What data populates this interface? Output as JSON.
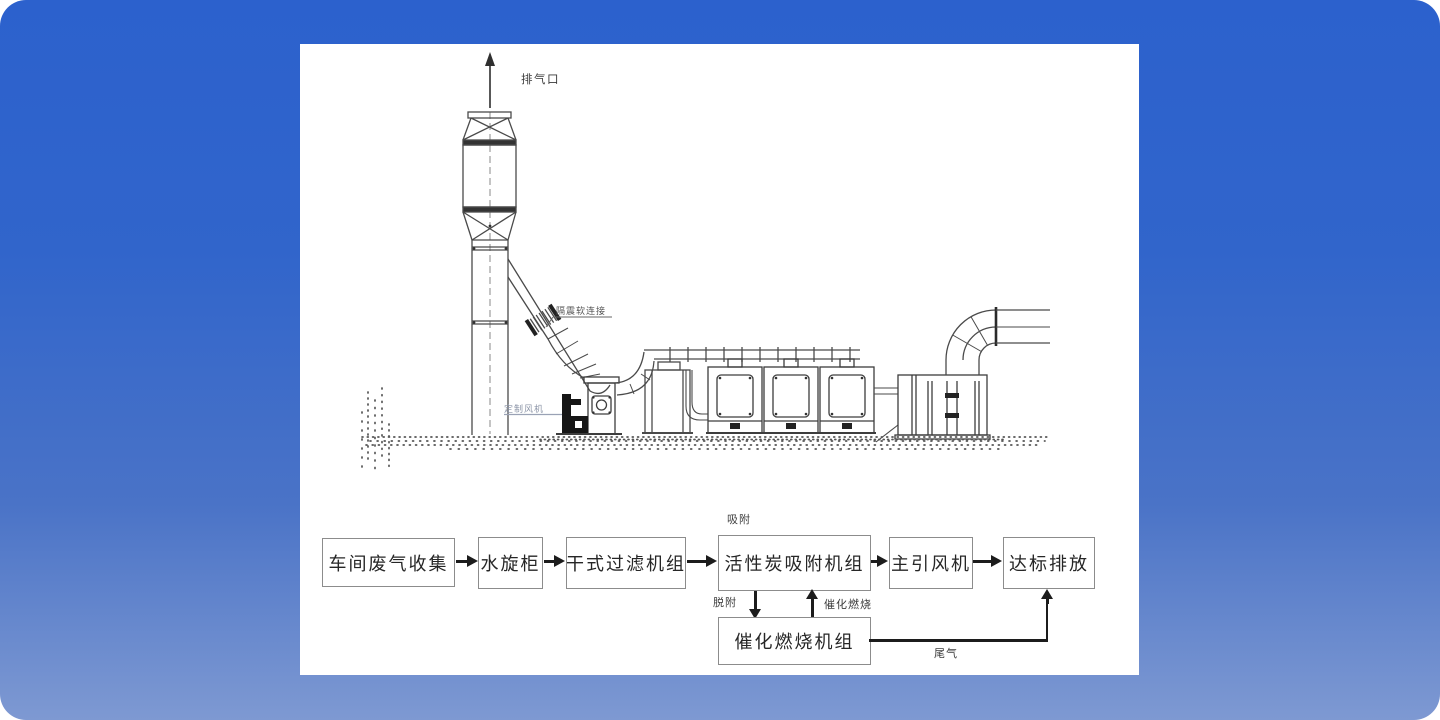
{
  "background": {
    "gradient_top": "#2c61cd",
    "gradient_bottom": "#7e99d2",
    "panel_color": "#ffffff"
  },
  "diagram": {
    "labels": {
      "exhaust_outlet": "排气口",
      "vibration_flex_connection": "隔震软连接",
      "custom_fan": "定制风机"
    }
  },
  "flowchart": {
    "boxes": [
      {
        "label": "车间废气收集"
      },
      {
        "label": "水旋柜"
      },
      {
        "label": "干式过滤机组"
      },
      {
        "label": "活性炭吸附机组"
      },
      {
        "label": "主引风机"
      },
      {
        "label": "达标排放"
      },
      {
        "label": "催化燃烧机组"
      }
    ],
    "annotations": {
      "adsorption": "吸附",
      "desorption": "脱附",
      "catalytic_combustion": "催化燃烧",
      "tail_gas": "尾气"
    }
  }
}
